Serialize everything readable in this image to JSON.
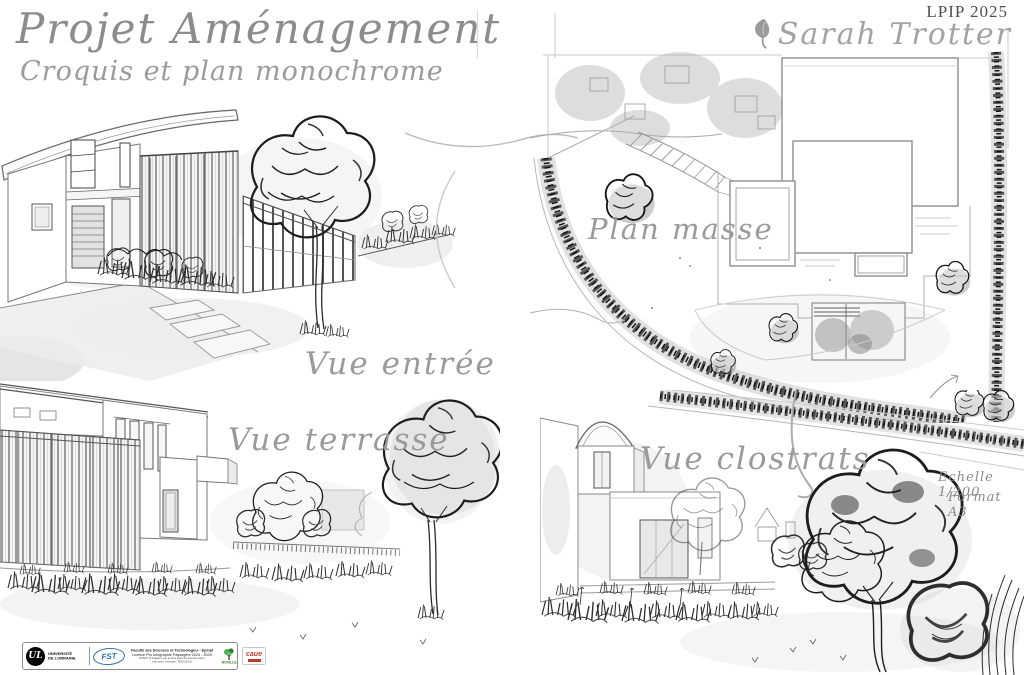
{
  "header": {
    "title": "Projet Aménagement",
    "subtitle": "Croquis et plan monochrome",
    "program_code": "LPIP 2025",
    "author": "Sarah Trotter"
  },
  "sketch_labels": {
    "entrance_view": "Vue entrée",
    "site_plan": "Plan masse",
    "terrace_view": "Vue terrasse",
    "claustra_view": "Vue clostrats"
  },
  "annotations": {
    "scale": "Echelle 1/200",
    "format": "Format A3"
  },
  "footer": {
    "university_monogram": "UL",
    "university_name": [
      "UNIVERSITÉ",
      "DE LORRAINE"
    ],
    "fst_acronym": "FST",
    "lines": [
      "Faculté des Sciences et Technologies - Epinal",
      "Licence Pro Infographie Paysagère 2024 - 2025",
      "NOM/T (n'indiquer que la 1ère lettre du prénom suivie",
      "d'un point, exemple : ROULE M.)"
    ],
    "roville_label": "ROVILLE",
    "partner_label": "caue"
  },
  "icons": {
    "author_leaf": "leaf-icon",
    "university_logo": "black-circle-UL-monogram",
    "fst_logo": "blue-oval-FST",
    "roville_logo": "green-tree-icon",
    "partner_logo": "red-caue-mark"
  },
  "colors": {
    "ink": "#2a2a2a",
    "pencil_gray": "#8c8c8c",
    "script_gray": "#9a9a9a",
    "wash_gray": "#bdbdbd",
    "fst_blue": "#2f6fb0",
    "roville_green": "#2e7d32",
    "partner_red": "#c0392b"
  }
}
